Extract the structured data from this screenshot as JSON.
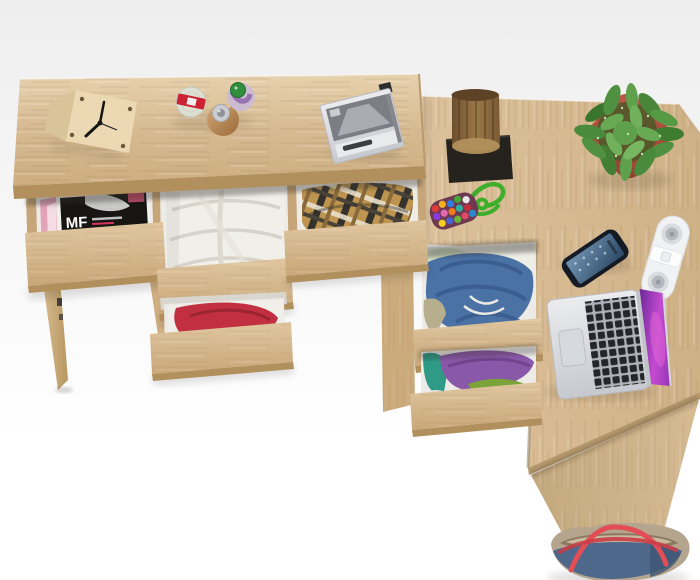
{
  "meta": {
    "scene_type": "product-photo",
    "subject": "Top view of a light oak L-shaped desk set with six open drawers holding magazines and folded clothes, styled with a cube clock, perfume bottles, CD player, log sculpture, potted plant, pompom keychain, smartphone, speaker, laptop and a tote bag"
  },
  "magazine": {
    "title": "MF"
  },
  "objects": [
    {
      "name": "cube-clock"
    },
    {
      "name": "perfume-bottle-red-cap"
    },
    {
      "name": "perfume-bottle-amber"
    },
    {
      "name": "perfume-bottle-green-cap"
    },
    {
      "name": "portable-cd-player"
    },
    {
      "name": "log-sculpture"
    },
    {
      "name": "potted-plant"
    },
    {
      "name": "pompom-keychain"
    },
    {
      "name": "smartphone"
    },
    {
      "name": "bluetooth-speaker"
    },
    {
      "name": "laptop"
    },
    {
      "name": "tote-bag"
    },
    {
      "name": "drawer-magazines"
    },
    {
      "name": "drawer-white-clothes"
    },
    {
      "name": "drawer-plaid-clothes"
    },
    {
      "name": "drawer-red-clothes"
    },
    {
      "name": "drawer-denim-clothes"
    },
    {
      "name": "drawer-purple-clothes"
    }
  ],
  "colors": {
    "bg-top": "#eeeeee",
    "bg": "#ffffff",
    "wood": "#d7ba91",
    "wood-light": "#e6d2ae",
    "wood-mid": "#cdae82",
    "wood-dark": "#c2a377",
    "wood-edge": "#b1905e",
    "panel-dark": "#c4a87e",
    "interior": "#edebe7",
    "divider": "#c6a678",
    "mag-black": "#171514",
    "mag-pink": "#e2a2b8",
    "cloth-white": "#f1efe9",
    "cloth-red": "#c22f40",
    "plaid-base": "#bd9550",
    "plaid-dark": "#35312c",
    "plaid-cream": "#e9e0cc",
    "denim": "#4a72a4",
    "denim-dark": "#38588a",
    "purple": "#8a58a8",
    "teal": "#2f9a86",
    "olive": "#7aa33a",
    "stump-a": "#6e4f2e",
    "stump-b": "#9a7848",
    "stump-cut": "#b2905c",
    "base-black": "#26231e",
    "pot": "#c05a48",
    "pot-dark": "#933f31",
    "leaf": "#4c8c3a",
    "leaf-dark": "#2e5c24",
    "leaf-light": "#72b15c",
    "cord-green": "#3fae2a",
    "phone-body": "#151b24",
    "phone-screen-a": "#7294b2",
    "phone-screen-b": "#2a4864",
    "speaker": "#f1f2f4",
    "grille": "#b4b9c0",
    "silver-a": "#ececee",
    "silver-b": "#c6c9cf",
    "keys": "#24262b",
    "screen-a": "#6a2a9a",
    "screen-b": "#c44ad0",
    "screen-c": "#8a30b0",
    "bag-blue": "#4d688a",
    "bag-tan": "#b5a48e",
    "bag-inner": "#8a7a62",
    "strap-red": "#e34d55",
    "hand-black": "#141414",
    "cap-red": "#cc2233",
    "cap-green": "#2f8f3c",
    "amber-a": "#d4a877",
    "amber-b": "#9a6a38",
    "pom-base": "#6e3a52"
  }
}
